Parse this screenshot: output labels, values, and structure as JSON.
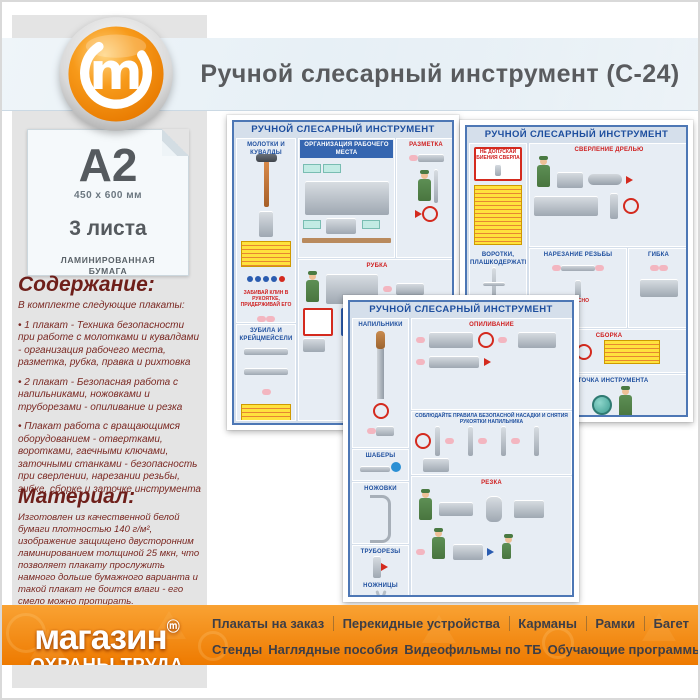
{
  "header": {
    "title": "Ручной слесарный инструмент (С-24)"
  },
  "spec_card": {
    "format": "А2",
    "size": "450 x 600 мм",
    "sheets": "3 листа",
    "paper_line1": "ЛАМИНИРОВАННАЯ",
    "paper_line2": "БУМАГА"
  },
  "contents": {
    "heading": "Содержание:",
    "intro": "В комплекте следующие плакаты:",
    "items": [
      "• 1 плакат - Техника безопасности при работе с молотками и кувалдами - организация рабочего места, разметка, рубка, правка и рихтовка",
      "• 2 плакат - Безопасная работа с напильниками, ножовками и труборезами - опиливание и резка",
      "• Плакат работа с вращающимся оборудованием - отвертками, воротками, гаечными ключами, заточными станками - безопасность при сверлении, нарезании резьбы, гибке, сборке и заточке инструмента"
    ]
  },
  "material": {
    "heading": "Материал:",
    "text": "Изготовлен из качественной белой бумаги плотностью 140 г/м², изображение защищено двусторонним ламинированием толщиной 25 мкн, что позволяет плакату прослужить намного дольше бумажного варианта и такой плакат не боится влаги - его смело можно протирать."
  },
  "posters": {
    "title": "РУЧНОЙ СЛЕСАРНЫЙ ИНСТРУМЕНТ",
    "danger_label": "ОПАСНО",
    "p1": {
      "hammers": "МОЛОТКИ И КУВАЛДЫ",
      "wedge_note": "ЗАБИВАЙ КЛИН В РУКОЯТКЕ, ПРИДЕРЖИВАЙ ЕГО",
      "chisels": "ЗУБИЛА И КРЕЙЦМЕЙСЕЛИ",
      "workplace": "ОРГАНИЗАЦИЯ РАБОЧЕГО МЕСТА",
      "marking": "РАЗМЕТКА",
      "chopping": "РУБКА"
    },
    "p2": {
      "warning": "НЕ ДОПУСКАЙ БИЕНИЯ СВЕРЛА",
      "drivers": "ВОРОТКИ, ПЛАШКОДЕРЖАТЕЛИ",
      "wrenches": "ГАЕЧНЫЕ КЛЮЧИ, ОТВЕРТКИ",
      "drilling": "СВЕРЛЕНИЕ ДРЕЛЬЮ",
      "threading": "НАРЕЗАНИЕ РЕЗЬБЫ",
      "bending": "ГИБКА",
      "assembly": "СБОРКА",
      "sharpening": "ЗАТОЧКА ИНСТРУМЕНТА"
    },
    "p3": {
      "files": "НАПИЛЬНИКИ",
      "filing": "ОПИЛИВАНИЕ",
      "rule_band": "СОБЛЮДАЙТЕ ПРАВИЛА БЕЗОПАСНОЙ НАСАДКИ И СНЯТИЯ РУКОЯТКИ НАПИЛЬНИКА",
      "scrapers": "ШАБЕРЫ",
      "hacksaws": "НОЖОВКИ",
      "pipe_cutters": "ТРУБОРЕЗЫ",
      "shears": "НОЖНИЦЫ",
      "cutting": "РЕЗКА"
    }
  },
  "footer": {
    "brand_line1": "магазин",
    "brand_mark": "ⓜ",
    "brand_line2": "ОХРАНЫ ТРУДА",
    "menu_row1": [
      "Плакаты на заказ",
      "Перекидные устройства",
      "Карманы",
      "Рамки",
      "Багет"
    ],
    "menu_row2": [
      "Стенды",
      "Наглядные пособия",
      "Видеофильмы по ТБ",
      "Обучающие программы"
    ]
  },
  "colors": {
    "accent_orange": "#f08000",
    "footer_gradient_top": "#f9a233",
    "footer_gradient_bottom": "#ee7a00",
    "maroon_text": "#7a2822",
    "poster_blue": "#1d4e9e",
    "poster_red": "#cf1f1f",
    "header_band_blue": "#e7f0f6",
    "gray_panel": "#e4e4e4"
  }
}
